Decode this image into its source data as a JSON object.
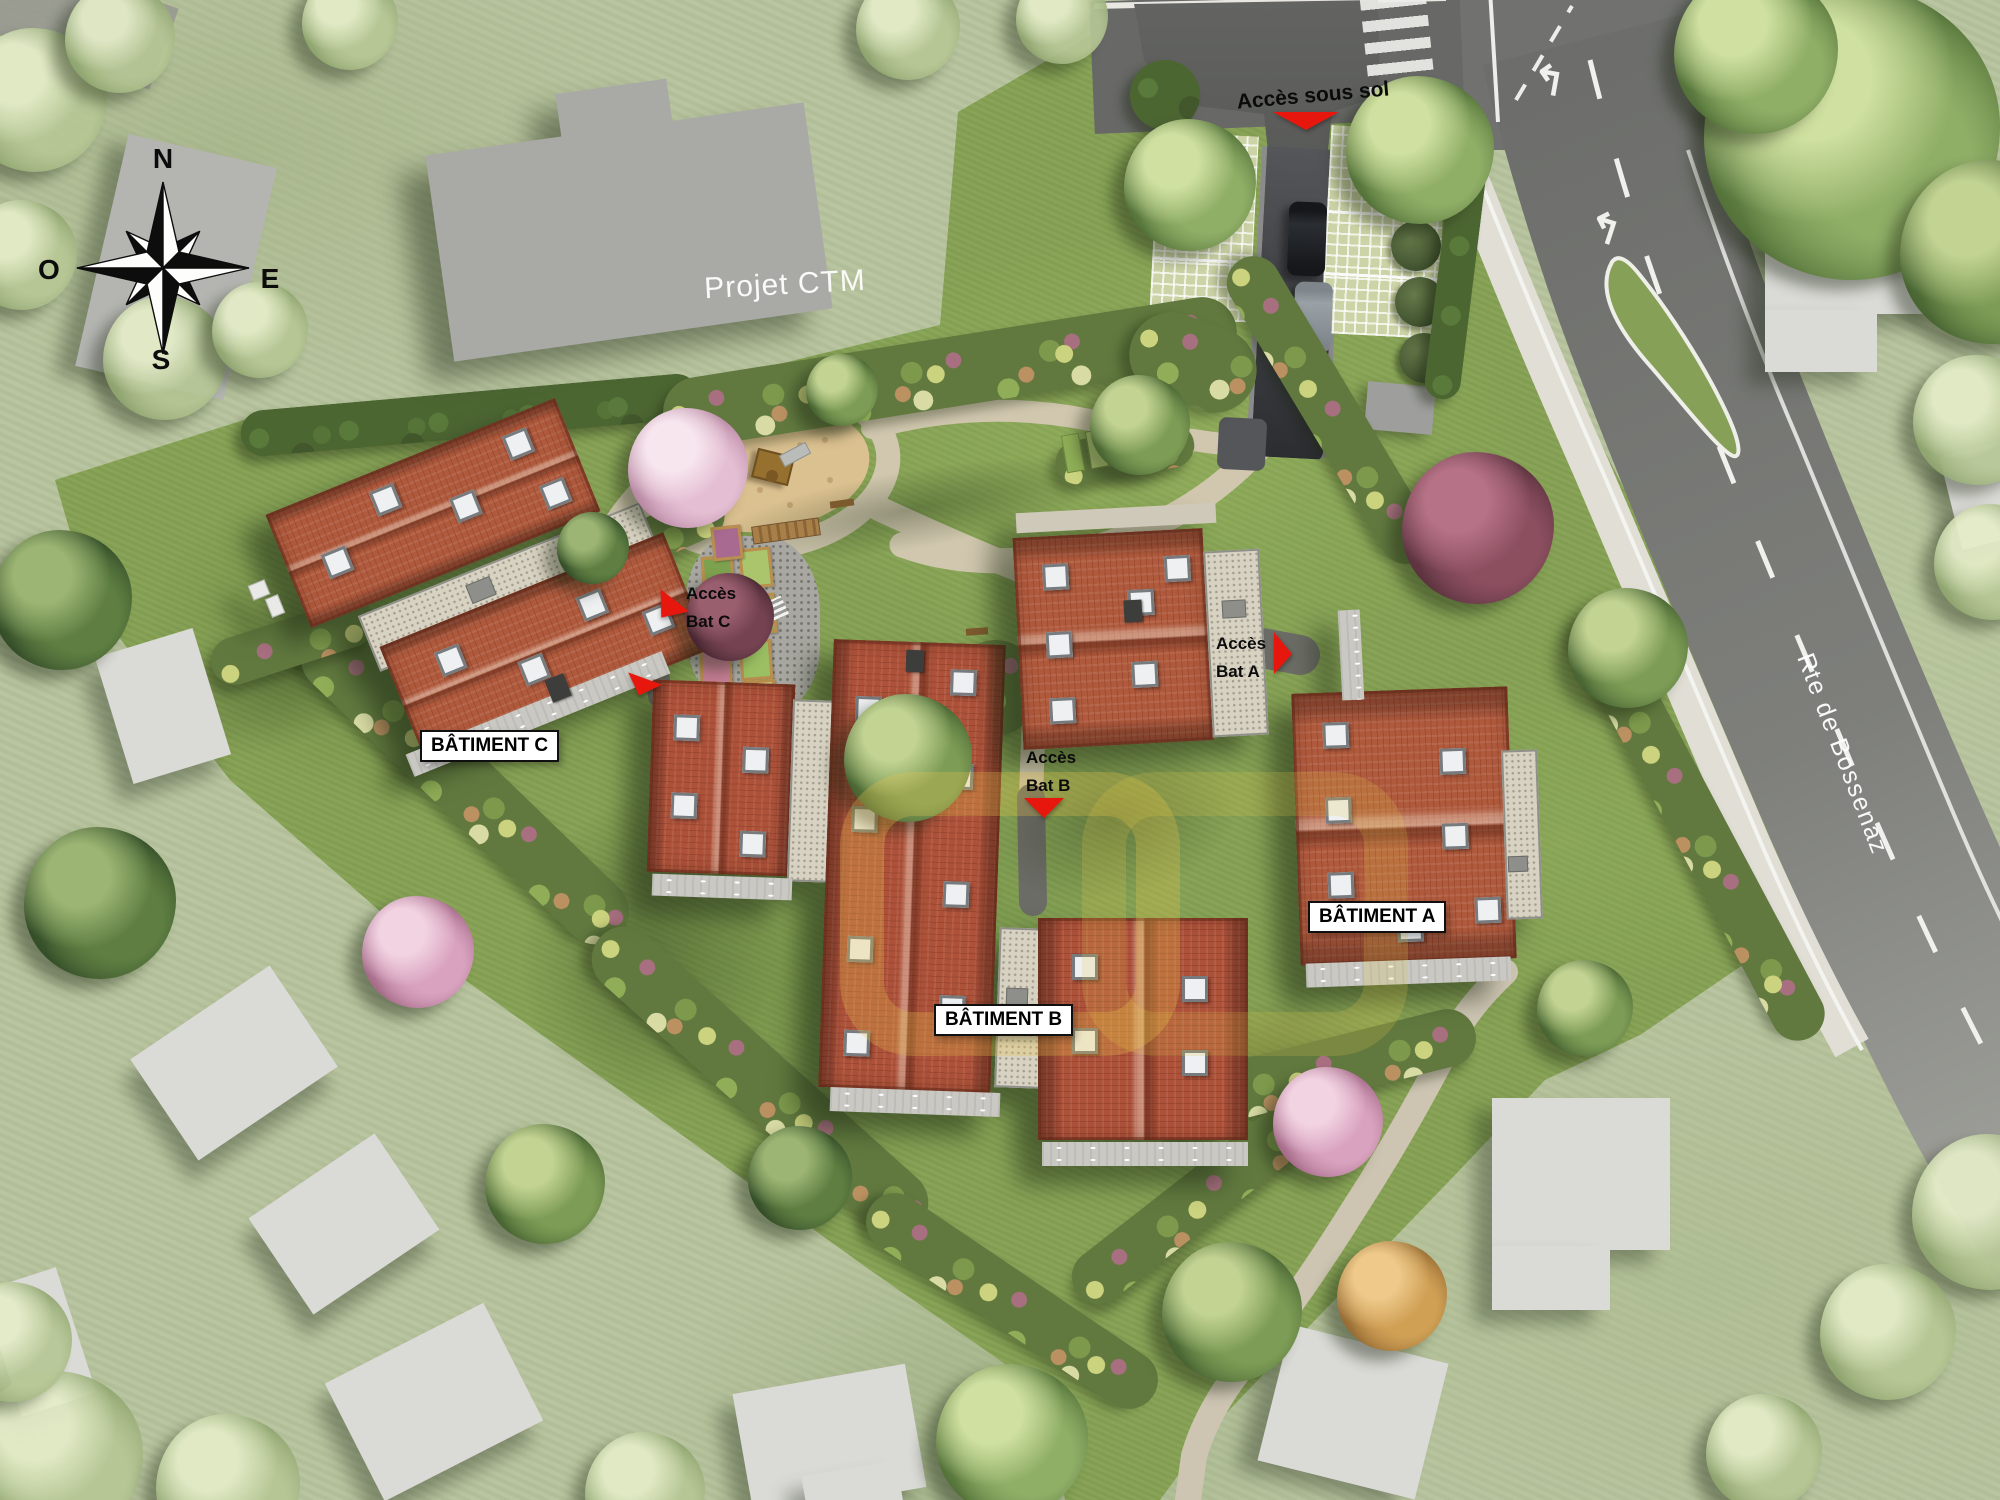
{
  "plan": {
    "compass": {
      "north": "N",
      "south": "S",
      "east": "E",
      "west": "O"
    },
    "adjacent_project": {
      "label": "Projet CTM"
    },
    "road": {
      "name": "Rte de Bossenaz"
    },
    "basement_access": {
      "label": "Accès sous sol"
    },
    "buildings": [
      {
        "id": "A",
        "label": "BÂTIMENT A",
        "access_line1": "Accès",
        "access_line2": "Bat A"
      },
      {
        "id": "B",
        "label": "BÂTIMENT B",
        "access_line1": "Accès",
        "access_line2": "Bat B"
      },
      {
        "id": "C",
        "label": "BÂTIMENT C",
        "access_line1": "Accès",
        "access_line2": "Bat C"
      }
    ],
    "colors": {
      "access_marker_red": "#e8170d",
      "roof_tiles": "#b05a3d",
      "site_grass": "#86a254",
      "road_asphalt": "#747572",
      "path_beige": "#d0c7ae",
      "label_background": "#ffffff",
      "label_border": "#101010",
      "road_text": "#ffffff",
      "neighbor_building_gray": "#a9aaa6"
    }
  }
}
